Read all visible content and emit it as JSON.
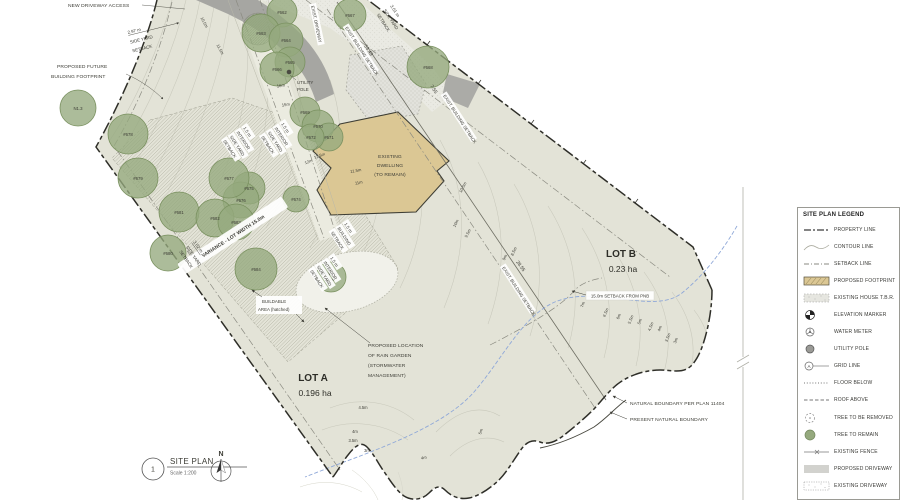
{
  "title_block": {
    "number": "1",
    "title": "SITE PLAN",
    "scale": "Scale 1:200",
    "north": "N"
  },
  "lots": {
    "a_name": "LOT A",
    "a_area": "0.196 ha",
    "b_name": "LOT B",
    "b_area": "0.23 ha"
  },
  "labels": {
    "nda": "NEW DRIVEWAY ACCESS",
    "pf": [
      "PROPOSED FUTURE",
      "BUILDING FOOTPRINT"
    ],
    "sy297": [
      "2.97 m",
      "SIDE YARD",
      "SETBACK"
    ],
    "sy301": [
      "3.01 m",
      "SIDE YARD",
      "SETBACK"
    ],
    "sy302": [
      "3.02 m",
      "SIDE YARD",
      "SETBACK"
    ],
    "int15": [
      "1.5 m",
      "INTERIOR",
      "SIDE YARD",
      "SETBACK"
    ],
    "bldg15": [
      "1.5 m",
      "BUILDING",
      "SETBACK"
    ],
    "ebs": "EXIST. BUILDING SETBACK",
    "edw": "EXIST. DRIVEWAY",
    "utility": [
      "UTILITY",
      "POLE"
    ],
    "dwelling": [
      "EXISTING",
      "DWELLING",
      "(TO REMAIN)"
    ],
    "variance": "VARIANCE - LOT WIDTH 15.0m",
    "buildable": [
      "BUILDABLE",
      "AREA (hatched)"
    ],
    "rain": [
      "PROPOSED LOCATION",
      "OF RAIN GARDEN",
      "(STORMWATER",
      "MANAGEMENT)"
    ],
    "pnb": "15.0m SETBACK FROM PNB",
    "nb_plan": "NATURAL BOUNDARY PER PLAN 11404",
    "nb_present": "PRESENT NATURAL BOUNDARY",
    "tripple": [
      "tripple",
      "pine"
    ]
  },
  "dimensions": {
    "lot_line_upper": "53.49",
    "lot_line_lower": "28.55",
    "setback_gap": "7.55"
  },
  "trees": [
    "N1.3",
    "#662",
    "#663",
    "#664",
    "#665",
    "#666",
    "#667",
    "#668",
    "#669",
    "#670",
    "#671",
    "#672",
    "#674",
    "#675",
    "#676",
    "#677",
    "#678",
    "#679",
    "#680",
    "#681",
    "#682",
    "#683",
    "#684"
  ],
  "contours": [
    "10.5m",
    "11.5m",
    "16m",
    "15m",
    "12.5m",
    "12m",
    "11.5m",
    "11m",
    "10.5m",
    "10m",
    "9.5m",
    "9m",
    "8.5m",
    "7m",
    "6.5m",
    "6m",
    "5.5m",
    "5m",
    "4.5m",
    "4m",
    "3.5m",
    "3m",
    "4.5m",
    "4m",
    "3.5m",
    "3m",
    "4m",
    "5m"
  ],
  "legend": {
    "title": "SITE PLAN LEGEND",
    "items": [
      "PROPERTY LINE",
      "CONTOUR LINE",
      "SETBACK LINE",
      "PROPOSED FOOTPRINT",
      "EXISTING HOUSE T.B.R.",
      "ELEVATION MARKER",
      "WATER METER",
      "UTILITY POLE",
      "GRID LINE",
      "FLOOR BELOW",
      "ROOF ABOVE",
      "TREE TO BE REMOVED",
      "TREE TO REMAIN",
      "EXISTING FENCE",
      "PROPOSED DRIVEWAY",
      "EXISTING DRIVEWAY"
    ]
  },
  "colors": {
    "site_fill": "#E3E3D7",
    "tree_fill": "#95A97E",
    "dwelling_fill": "#DBC794",
    "driveway_gray": "#A6A6A2",
    "boundary": "#2E2E28",
    "water_blue": "#8FA8D8"
  }
}
